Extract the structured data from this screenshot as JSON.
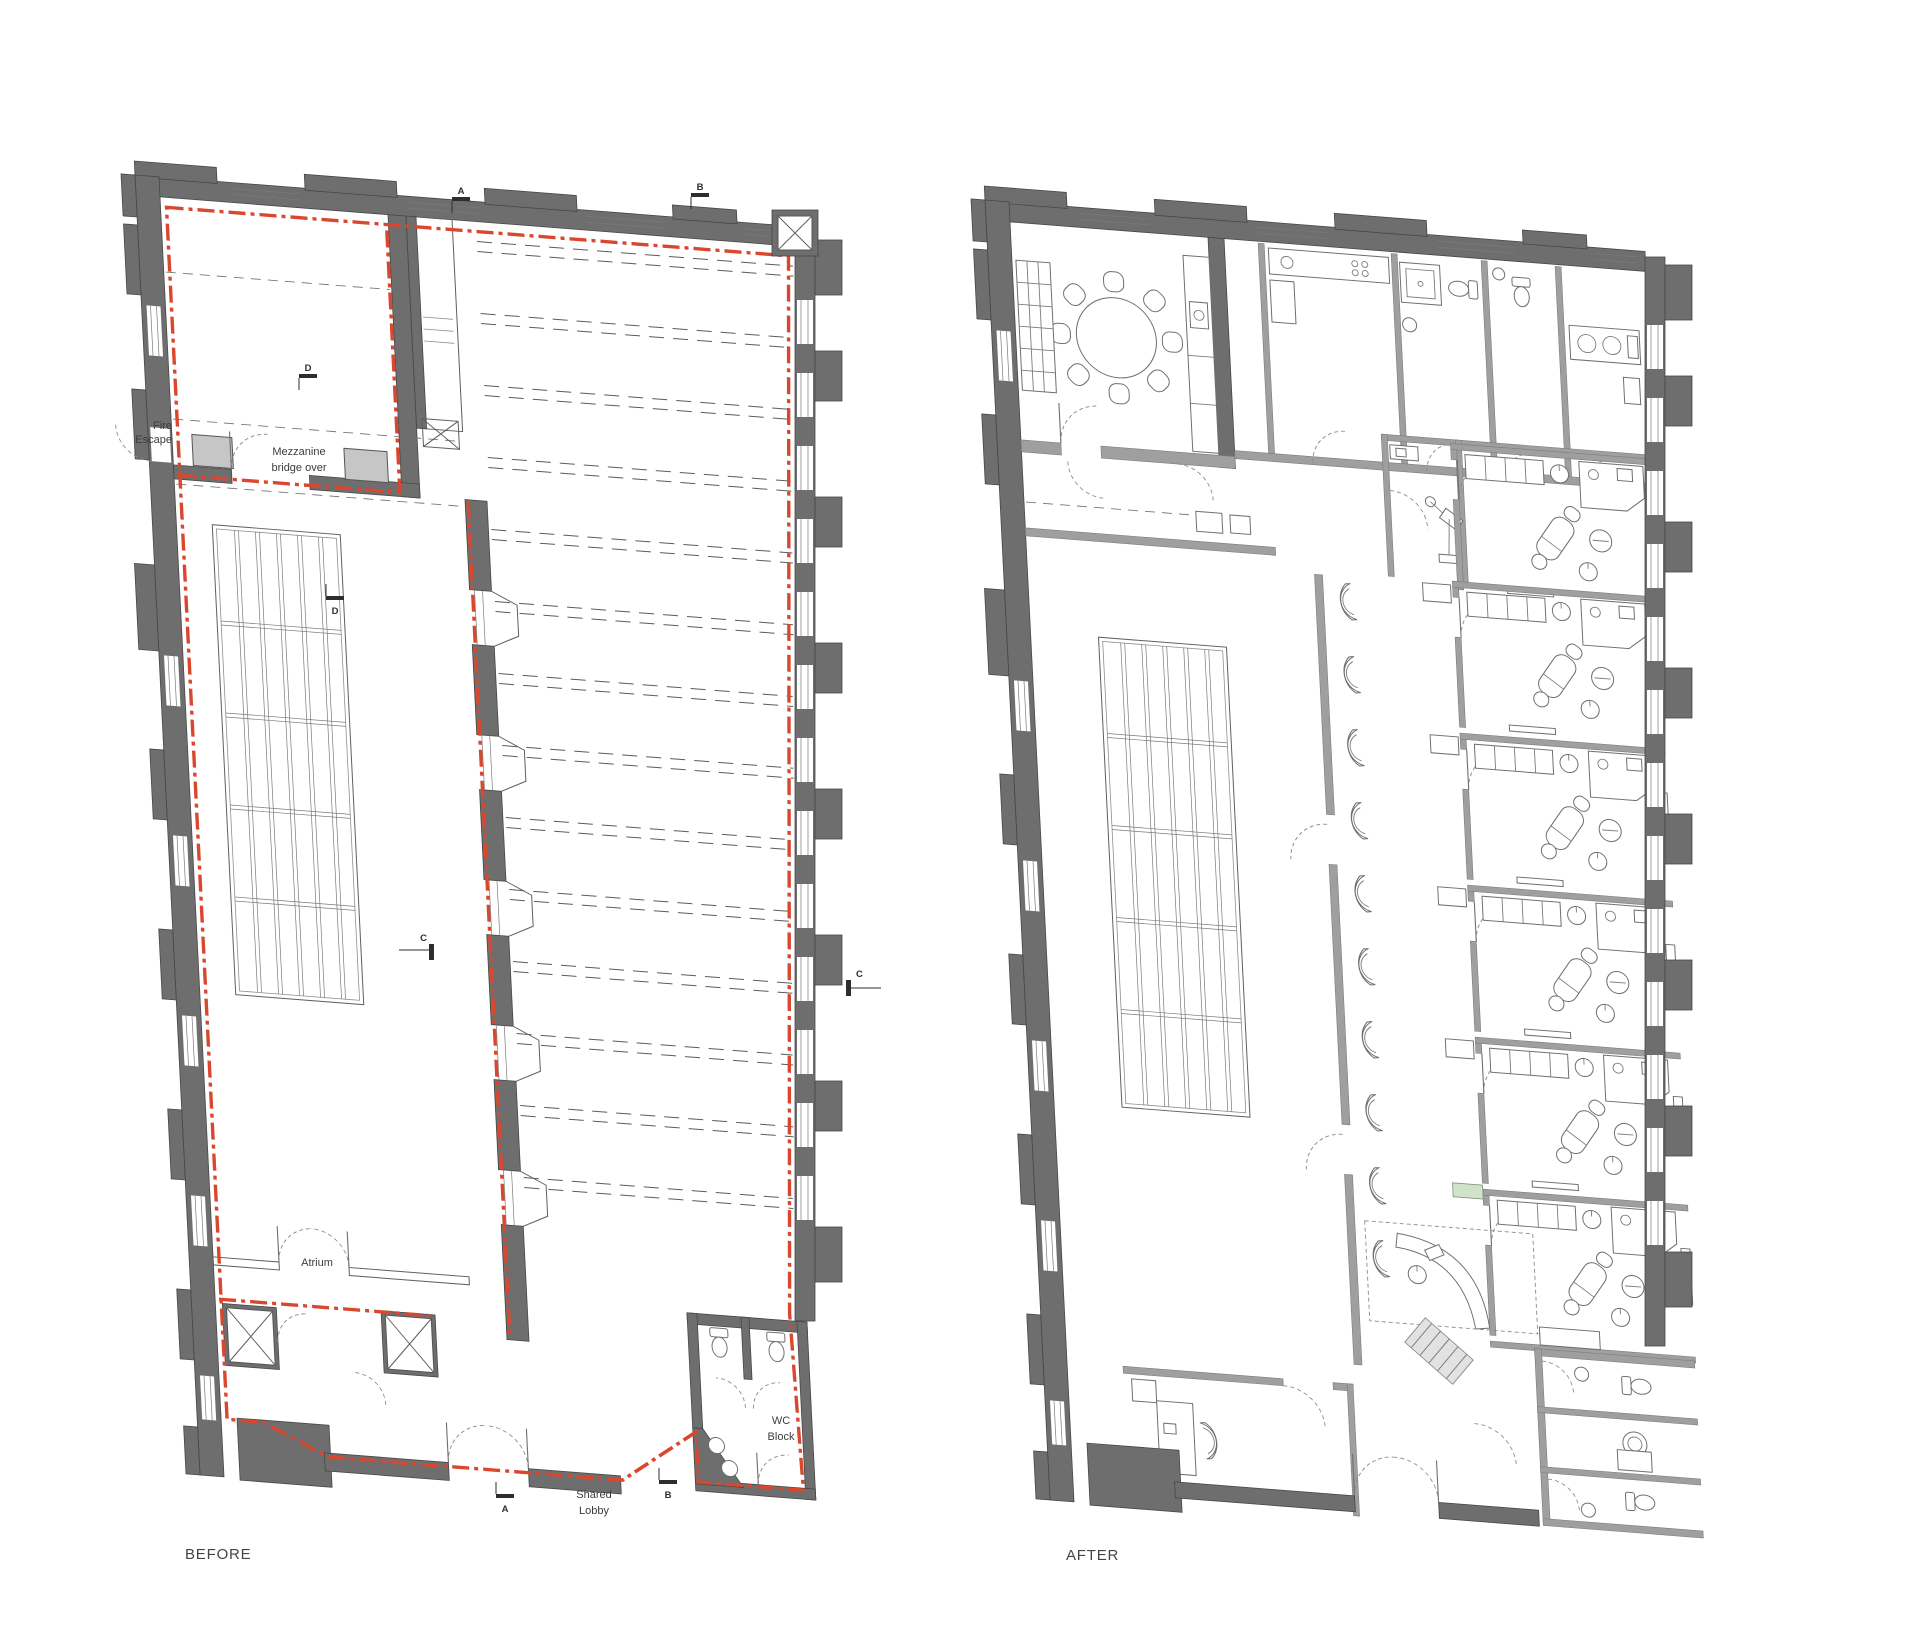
{
  "drawing": {
    "type": "architectural-floor-plan-comparison",
    "background": "#ffffff"
  },
  "colors": {
    "wall_gray": "#6e6e6e",
    "light_wall_gray": "#9f9f9f",
    "pier_gray": "#c6c6c6",
    "demolition_red": "#d9472f",
    "accent_green": "#cfe3c9",
    "line_gray": "#5f5f5f",
    "text_gray": "#3c3c3c"
  },
  "before": {
    "caption": "BEFORE",
    "labels": {
      "fire_escape": [
        "Fire",
        "Escape"
      ],
      "mezzanine": [
        "Mezzanine",
        "bridge over"
      ],
      "atrium": "Atrium",
      "wc_block": [
        "WC",
        "Block"
      ],
      "shared_lobby": [
        "Shared",
        "Lobby"
      ]
    },
    "markers": {
      "a_top": "A",
      "b_top": "B",
      "c_left": "C",
      "c_right": "C",
      "d_upper": "D",
      "d_lower": "D",
      "a_bottom": "A",
      "b_bottom": "B"
    }
  },
  "after": {
    "caption": "AFTER"
  }
}
